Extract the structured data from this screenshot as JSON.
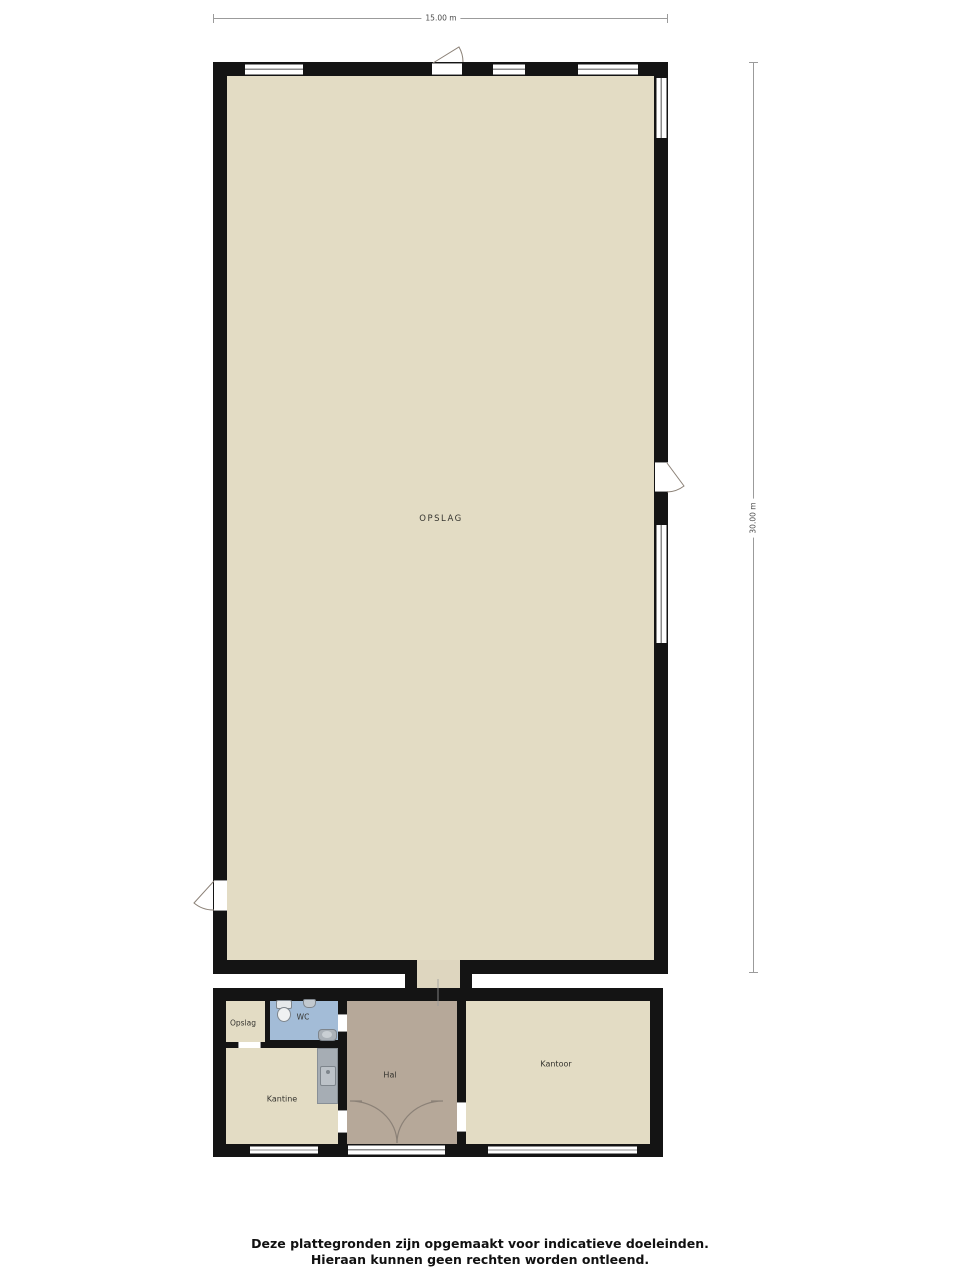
{
  "dimensions": {
    "width_label": "15.00 m",
    "height_label": "30.00 m"
  },
  "rooms": {
    "opslag_main": {
      "label": "OPSLAG"
    },
    "opslag_small": {
      "label": "Opslag"
    },
    "wc": {
      "label": "WC"
    },
    "hal": {
      "label": "Hal"
    },
    "kantine": {
      "label": "Kantine"
    },
    "kantoor": {
      "label": "Kantoor"
    }
  },
  "footer": {
    "line1": "Deze plattegronden zijn opgemaakt voor indicatieve doeleinden.",
    "line2": "Hieraan kunnen geen rechten worden ontleend."
  },
  "colors": {
    "wall": "#141414",
    "floor": "#e3dcc4",
    "hal_floor": "#b6a899",
    "wc_floor": "#a3bcd7",
    "counter": "#a6adb4",
    "background": "#ffffff"
  }
}
